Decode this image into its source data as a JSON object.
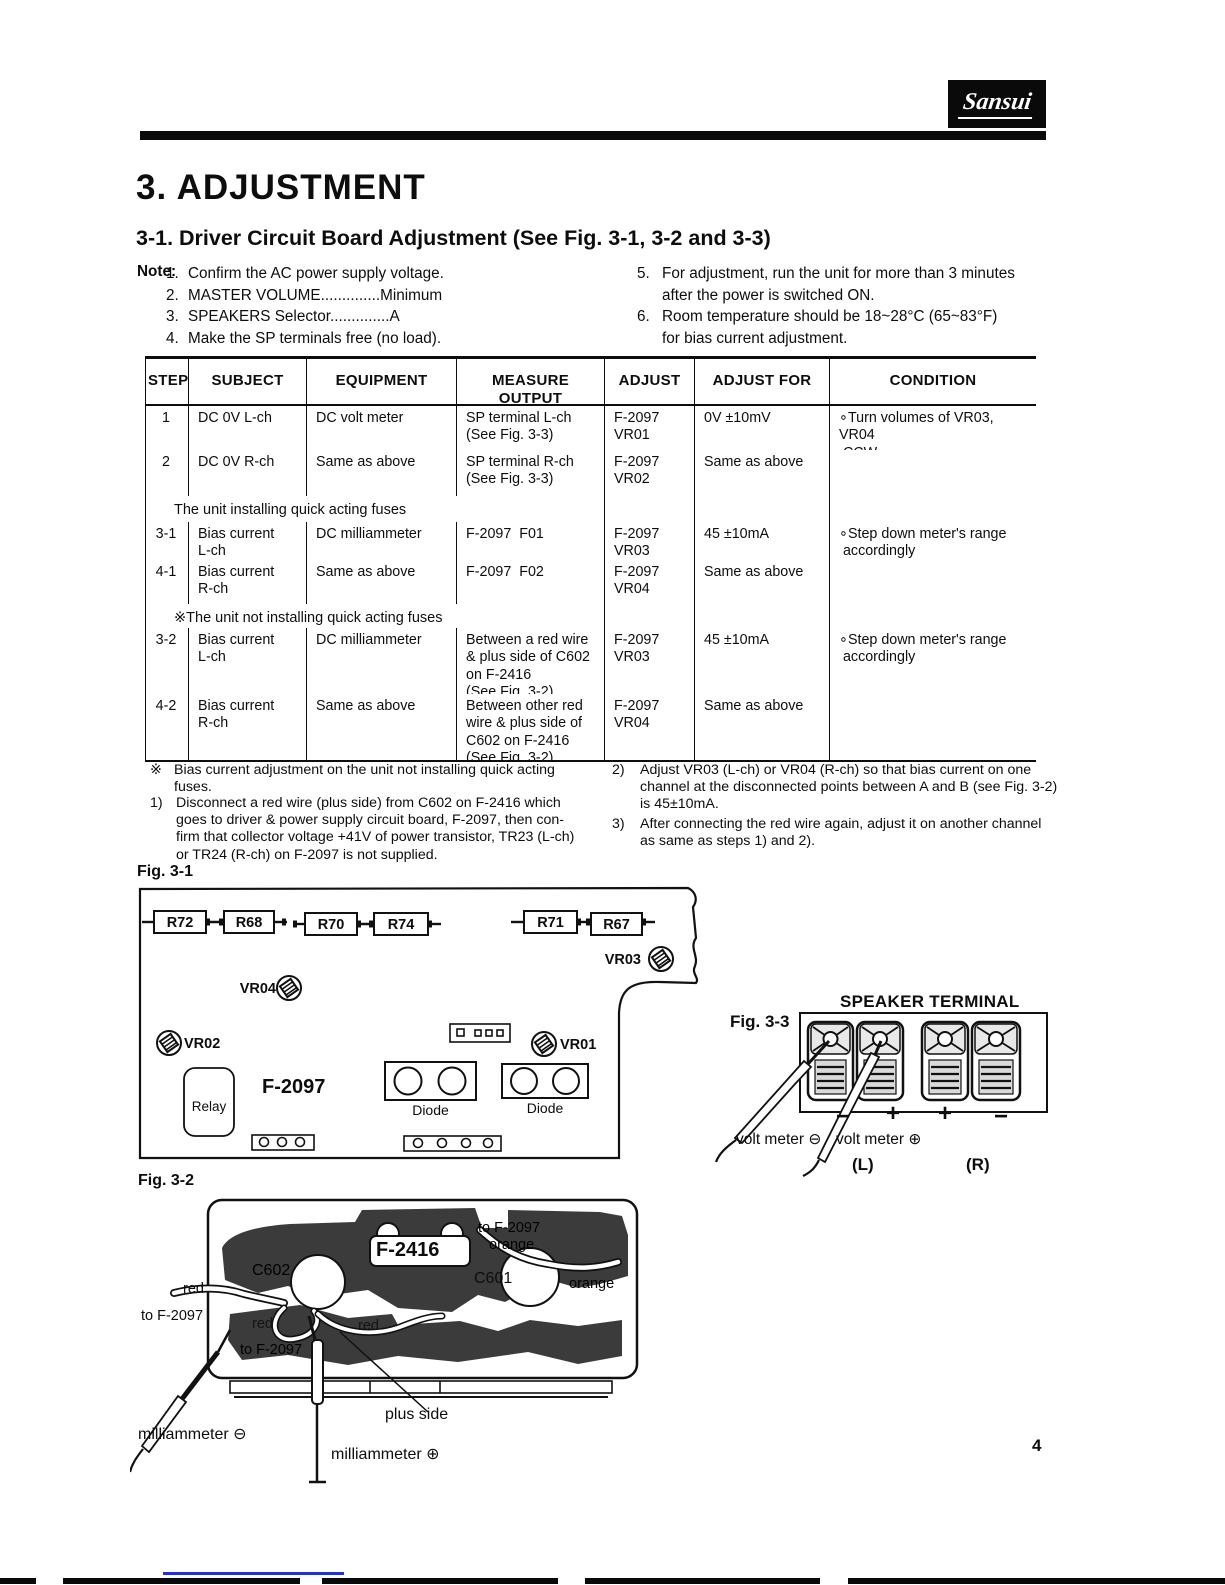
{
  "page": {
    "brand": "Sansui",
    "title": "3. ADJUSTMENT",
    "subtitle": "3-1. Driver Circuit Board Adjustment (See Fig. 3-1, 3-2 and 3-3)",
    "page_number": "4"
  },
  "notes": {
    "label": "Note:",
    "left": [
      {
        "m": "1.",
        "t": "Confirm the AC power supply voltage."
      },
      {
        "m": "2.",
        "t": "MASTER VOLUME..............Minimum"
      },
      {
        "m": "3.",
        "t": "SPEAKERS Selector..............A"
      },
      {
        "m": "4.",
        "t": "Make the SP terminals free (no load)."
      }
    ],
    "right": [
      {
        "m": "5.",
        "t": "For adjustment, run the unit for more than 3 minutes\nafter the power is switched ON."
      },
      {
        "m": "6.",
        "t": "Room temperature should be 18~28°C (65~83°F)\nfor bias current adjustment."
      }
    ]
  },
  "table": {
    "headers": [
      "STEP",
      "SUBJECT",
      "EQUIPMENT",
      "MEASURE OUTPUT",
      "ADJUST",
      "ADJUST FOR",
      "CONDITION"
    ],
    "rows": [
      {
        "type": "data",
        "cells": [
          "1",
          "DC 0V L-ch",
          "DC volt meter",
          "SP terminal L-ch\n(See Fig. 3-3)",
          "F-2097\nVR01",
          "0V ±10mV",
          "∘Turn volumes of VR03, VR04\n CCW"
        ]
      },
      {
        "type": "data",
        "cells": [
          "2",
          "DC 0V R-ch",
          "Same as above",
          "SP terminal R-ch\n(See Fig. 3-3)",
          "F-2097\nVR02",
          "Same as above",
          ""
        ]
      },
      {
        "type": "section",
        "text": "The unit installing quick acting fuses"
      },
      {
        "type": "data",
        "cells": [
          "3-1",
          "Bias current\nL-ch",
          "DC milliammeter",
          "F-2097  F01",
          "F-2097\nVR03",
          "45 ±10mA",
          "∘Step down meter's range\n accordingly"
        ]
      },
      {
        "type": "data",
        "cells": [
          "4-1",
          "Bias current\nR-ch",
          "Same as above",
          "F-2097  F02",
          "F-2097\nVR04",
          "Same as above",
          ""
        ]
      },
      {
        "type": "section",
        "text": "※The unit not installing quick acting fuses"
      },
      {
        "type": "data",
        "cells": [
          "3-2",
          "Bias current\nL-ch",
          "DC milliammeter",
          "Between a red wire\n& plus side of C602\non F-2416\n(See Fig. 3-2)",
          "F-2097\nVR03",
          "45 ±10mA",
          "∘Step down meter's range\n accordingly"
        ]
      },
      {
        "type": "data",
        "cells": [
          "4-2",
          "Bias current\nR-ch",
          "Same as above",
          "Between other red\nwire & plus side of\nC602 on F-2416\n(See Fig. 3-2)",
          "F-2097\nVR04",
          "Same as above",
          ""
        ]
      }
    ]
  },
  "footnotes": {
    "left": [
      {
        "m": "※",
        "t": "Bias current adjustment on the unit not installing quick acting\nfuses."
      },
      {
        "m": "1)",
        "t": "Disconnect a red wire (plus side) from C602 on F-2416 which\ngoes to driver & power supply circuit board, F-2097, then con-\nfirm that collector voltage +41V of power transistor, TR23 (L-ch)\nor TR24 (R-ch) on F-2097 is not supplied."
      }
    ],
    "right": [
      {
        "m": "2)",
        "t": "Adjust VR03 (L-ch) or VR04 (R-ch) so that bias current on one\nchannel at the disconnected points between A and B (see Fig. 3-2)\nis 45±10mA."
      },
      {
        "m": "3)",
        "t": "After connecting the red wire again, adjust it on another channel\nas same as steps 1) and 2)."
      }
    ]
  },
  "fig31": {
    "caption": "Fig. 3-1",
    "board": "F-2097",
    "r": [
      "R72",
      "R68",
      "R70",
      "R74",
      "R71",
      "R67"
    ],
    "vr": [
      "VR04",
      "VR03",
      "VR02",
      "VR01"
    ],
    "relay": "Relay",
    "diode1": "Diode",
    "diode2": "Diode"
  },
  "fig33": {
    "caption": "Fig. 3-3",
    "title": "SPEAKER TERMINAL",
    "signs": [
      "−",
      "+",
      "+",
      "−"
    ],
    "probe_neg": "volt meter ⊖",
    "probe_pos": "volt meter ⊕",
    "left_ch": "(L)",
    "right_ch": "(R)"
  },
  "fig32": {
    "caption": "Fig. 3-2",
    "board": "F-2416",
    "to_f2097_top": "to F-2097",
    "orange_top": "orange",
    "c601": "C601",
    "orange_right": "orange",
    "c602": "C602",
    "red_left": "red",
    "to_f2097_left": "to F-2097",
    "red_mid1": "red",
    "red_mid2": "red",
    "to_f2097_bottom": "to F-2097",
    "plus_side": "plus side",
    "ma_neg": "milliammeter ⊖",
    "ma_pos": "milliammeter ⊕"
  }
}
